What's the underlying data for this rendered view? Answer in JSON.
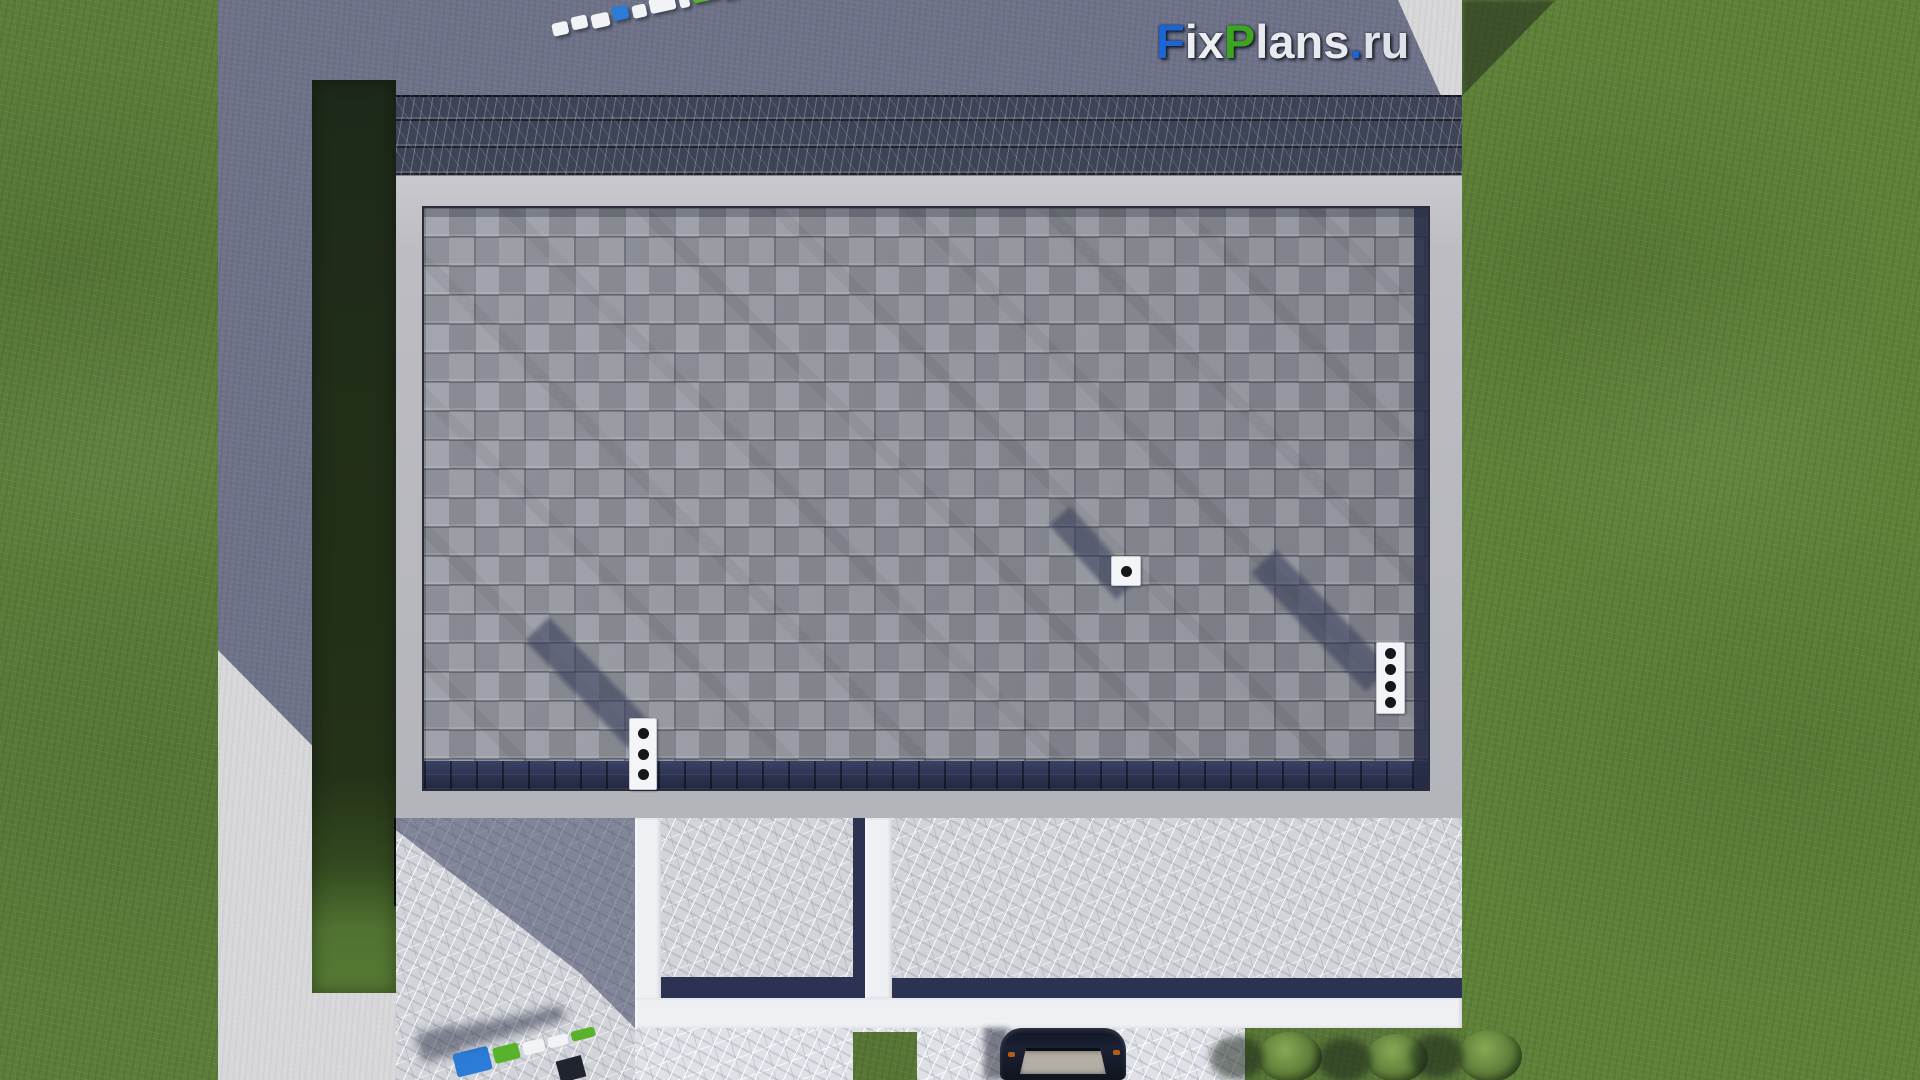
{
  "watermark": {
    "text": "FixPlans.ru",
    "segments": [
      {
        "text": "F",
        "color": "#1a66d6"
      },
      {
        "text": "ix",
        "color": "#eceef2"
      },
      {
        "text": "P",
        "color": "#3ca61f"
      },
      {
        "text": "lans",
        "color": "#e8eaef"
      },
      {
        "text": ".",
        "color": "#1a66d6"
      },
      {
        "text": "ru",
        "color": "#dfe2e8"
      }
    ]
  },
  "palette": {
    "grass_sunlit": "#5b7d39",
    "grass_shadow": "#2c3a26",
    "hedge_dark": "#22301a",
    "concrete_sunlit": "#d8d8da",
    "concrete_shadow": "#6e7389",
    "step_slate": "#3d4456",
    "roof_frame": "#bfbfc5",
    "shingle_gray": "#979aa4",
    "shingle_eave_navy": "#2e355a",
    "terrace_marble": "#d2d4da",
    "terrace_navy_edge": "#2b3252",
    "beam_white": "#eef0f3",
    "car_body": "#131927"
  },
  "markers": {
    "colors": {
      "white": "#f2f3f5",
      "blue": "#2a7cd6",
      "green": "#58b32a"
    },
    "top": [
      {
        "c": "white",
        "w": 16,
        "h": 13
      },
      {
        "c": "white",
        "w": 16,
        "h": 13
      },
      {
        "c": "white",
        "w": 18,
        "h": 14
      },
      {
        "c": "blue",
        "w": 16,
        "h": 14
      },
      {
        "c": "white",
        "w": 14,
        "h": 13
      },
      {
        "c": "white",
        "w": 26,
        "h": 15
      },
      {
        "c": "white",
        "w": 10,
        "h": 12
      },
      {
        "c": "green",
        "w": 26,
        "h": 14
      },
      {
        "c": "white",
        "w": 16,
        "h": 14
      },
      {
        "c": "white",
        "w": 16,
        "h": 14
      },
      {
        "c": "green",
        "w": 12,
        "h": 12
      },
      {
        "c": "blue",
        "w": 24,
        "h": 18
      }
    ],
    "bottom": [
      {
        "c": "blue",
        "w": 36,
        "h": 24
      },
      {
        "c": "green",
        "w": 26,
        "h": 16
      },
      {
        "c": "white",
        "w": 22,
        "h": 13
      },
      {
        "c": "white",
        "w": 20,
        "h": 11
      },
      {
        "c": "green",
        "w": 24,
        "h": 10
      }
    ]
  },
  "objects": {
    "chimney_left": {
      "flues": 3
    },
    "chimney_right": {
      "flues": 4
    },
    "roof_vent": {
      "flues": 1
    },
    "bushes": {
      "count": 3
    },
    "car": {
      "present": true
    }
  }
}
